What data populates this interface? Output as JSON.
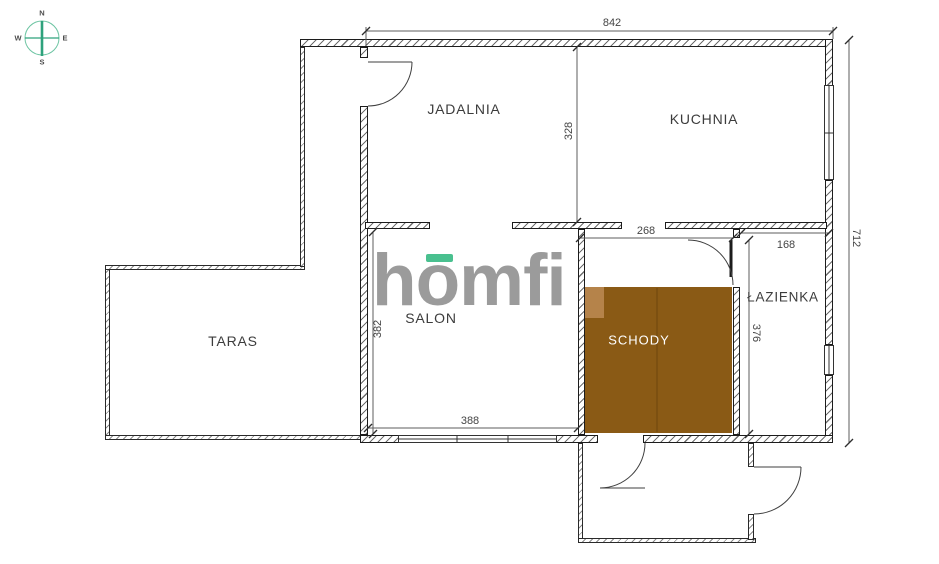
{
  "plan": {
    "compass": {
      "north": "N",
      "south": "S",
      "east": "E",
      "west": "W"
    },
    "logo": {
      "wordmark": "homfi"
    },
    "rooms": {
      "jadalnia": "JADALNIA",
      "kuchnia": "KUCHNIA",
      "salon": "SALON",
      "taras": "TARAS",
      "schody": "SCHODY",
      "lazienka": "ŁAZIENKA"
    },
    "dimensions": {
      "total_width": "842",
      "upper_depth": "328",
      "right_height": "712",
      "stairs_width": "268",
      "bathroom_width": "168",
      "salon_width": "388",
      "salon_depth": "382",
      "bathroom_depth": "376"
    },
    "colors": {
      "stairs_fill": "#8a5a15",
      "stairs_landing": "#b5834a",
      "brand_teal": "#49c08f",
      "logo_gray": "#9b9b9b"
    }
  }
}
